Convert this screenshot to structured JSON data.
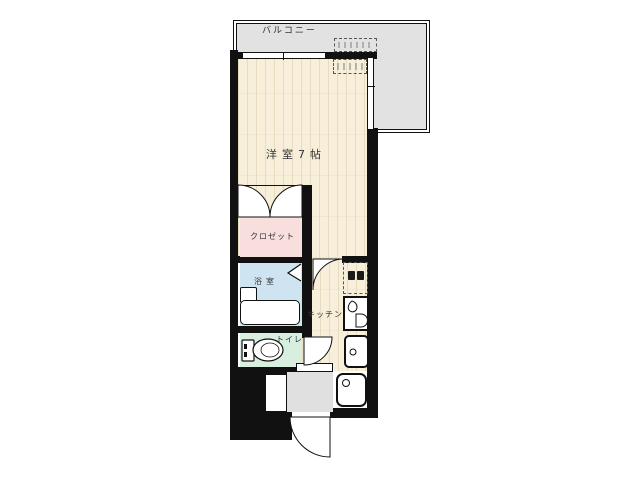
{
  "floorplan": {
    "labels": {
      "balcony": "バルコニー",
      "room": "洋室7帖",
      "closet": "クロゼット",
      "bath": "浴室",
      "kitchen": "キッチン",
      "toilet": "トイレ"
    },
    "colors": {
      "wall": "#111111",
      "balcony_fill": "#e2e2e2",
      "wood_fill": "#f8efdb",
      "wood_line": "#e8dcc0",
      "closet_fill": "#f9dede",
      "bath_fill": "#cfe4f1",
      "toilet_fill": "#d8efdf",
      "entrance_fill": "#e0e0e0",
      "label_text": "#333333"
    }
  }
}
